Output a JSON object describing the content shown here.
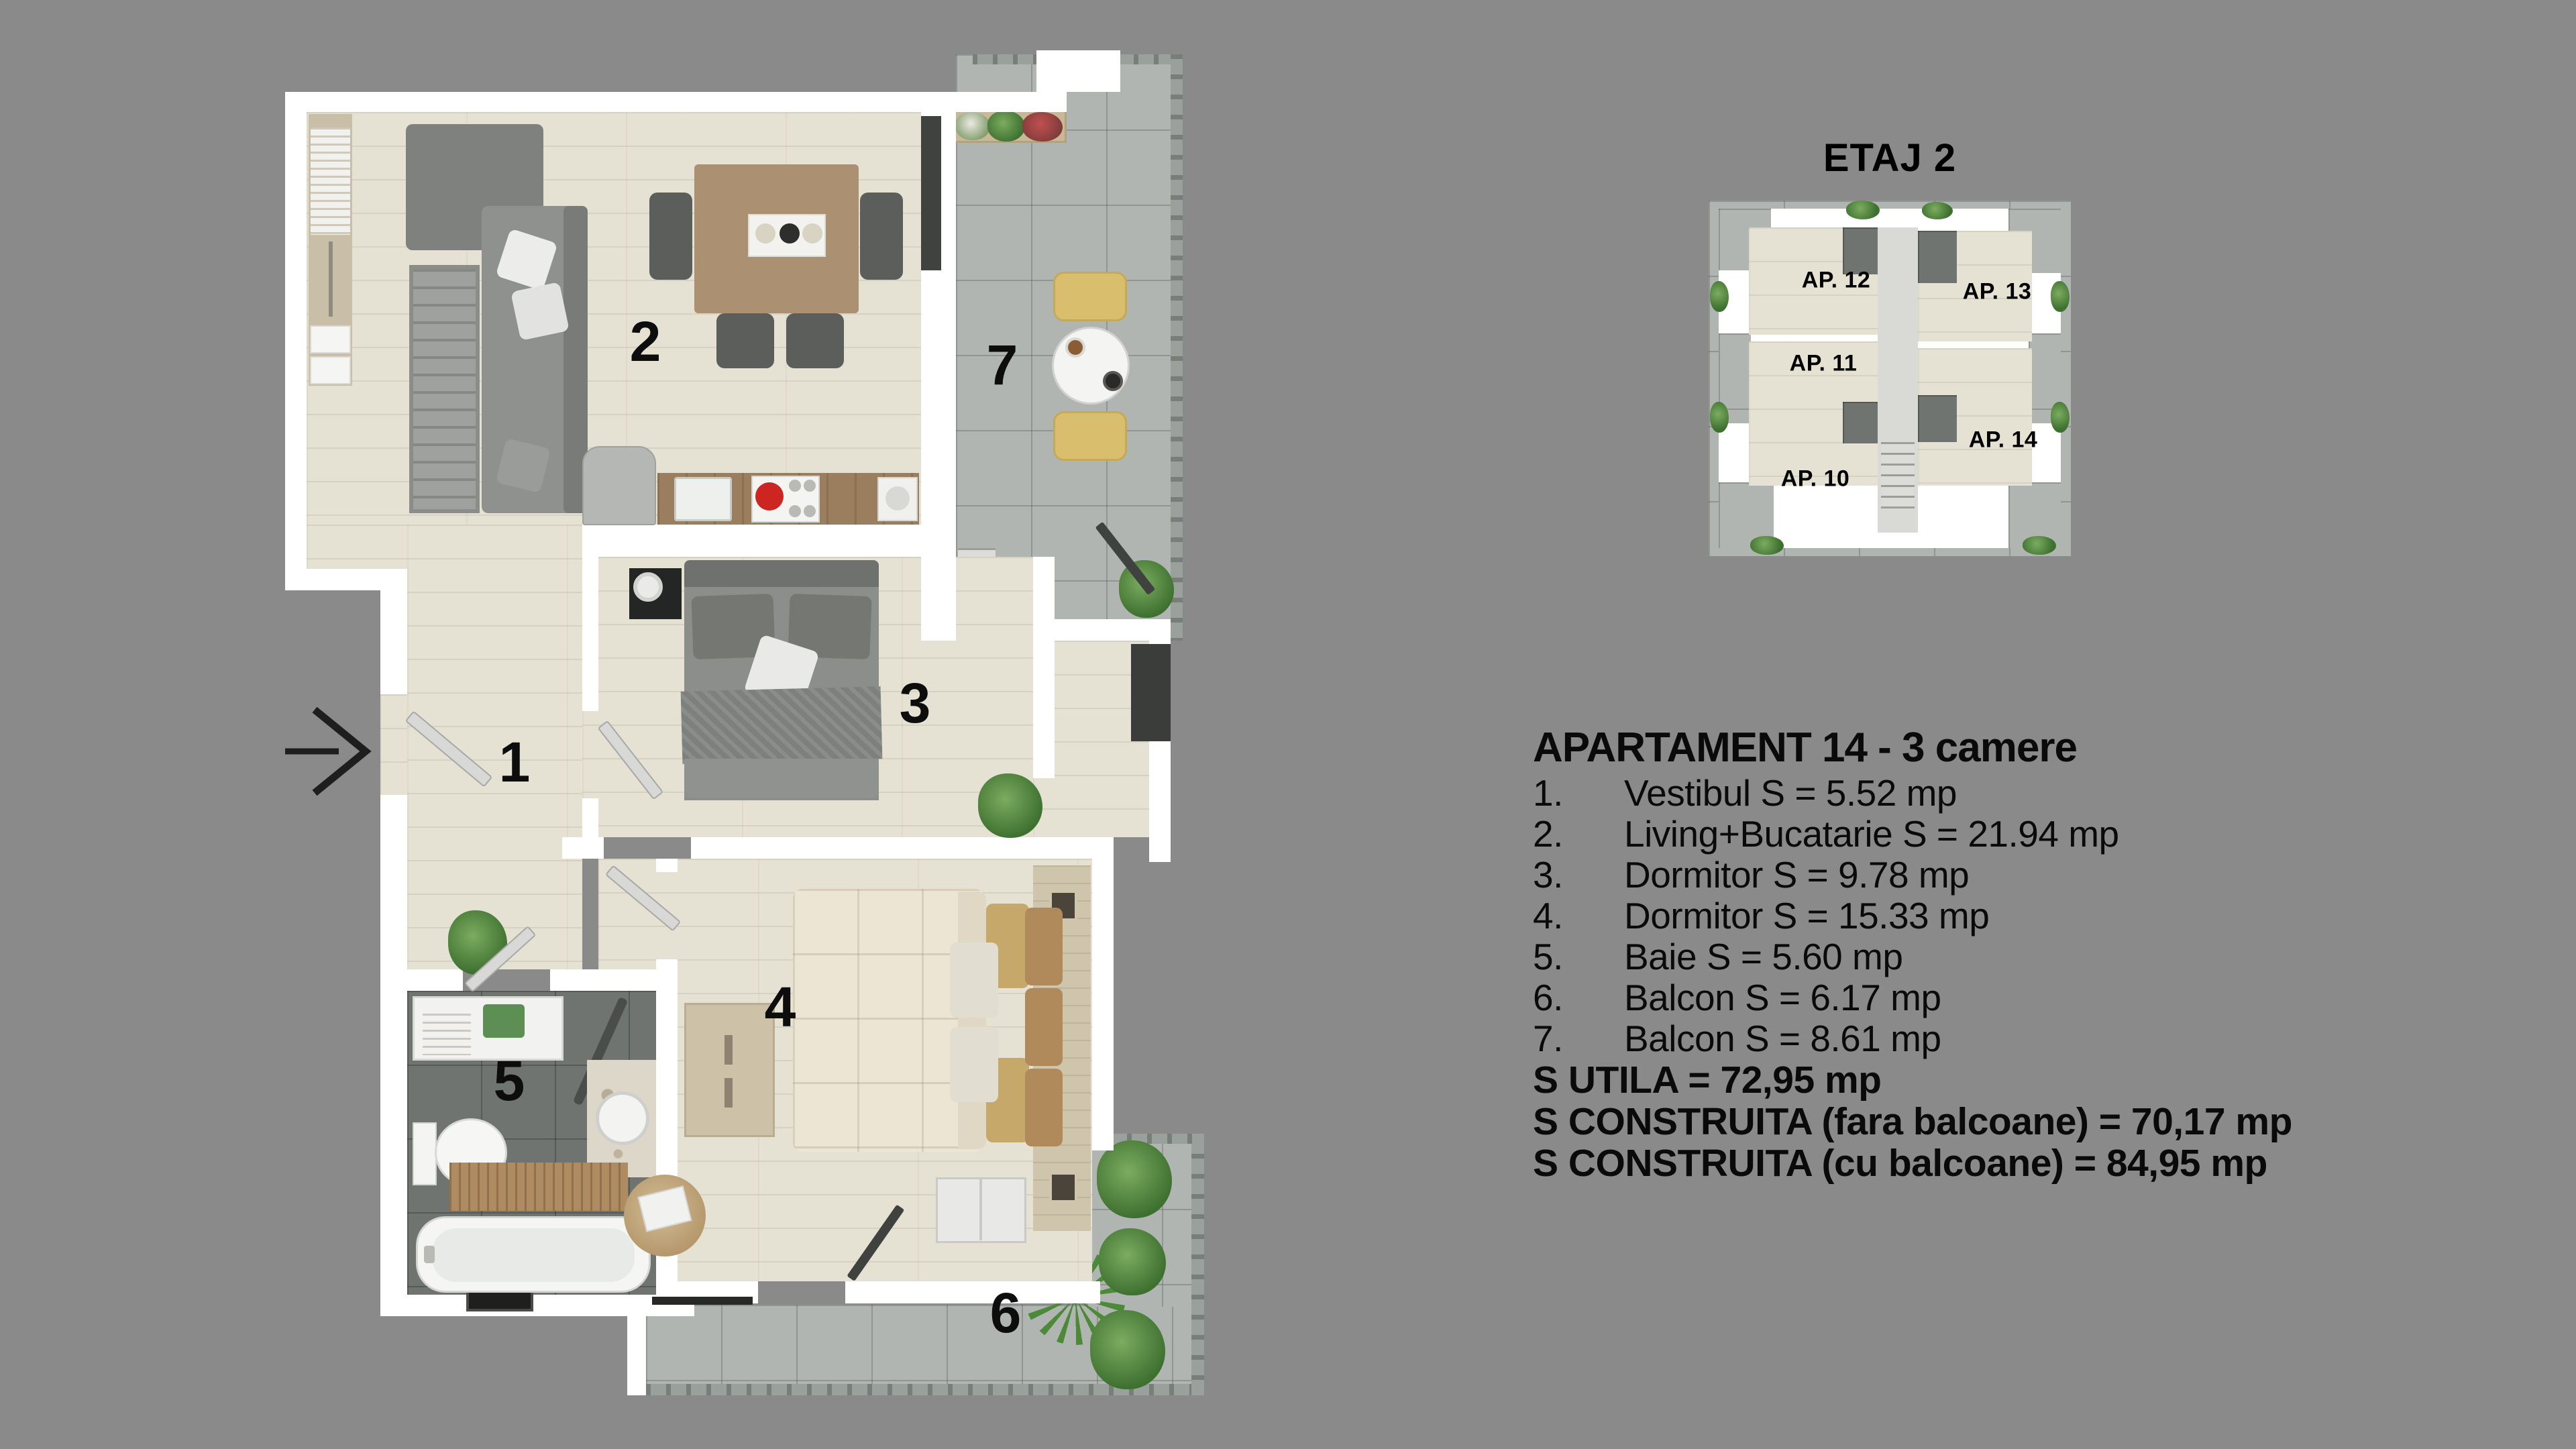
{
  "etaj_title": "ETAJ 2",
  "mini_plan": {
    "apartments": [
      {
        "label": "AP. 12"
      },
      {
        "label": "AP. 13"
      },
      {
        "label": "AP. 11"
      },
      {
        "label": "AP. 14"
      },
      {
        "label": "AP. 10"
      }
    ]
  },
  "floor_plan": {
    "rooms": [
      {
        "number": "1"
      },
      {
        "number": "2"
      },
      {
        "number": "3"
      },
      {
        "number": "4"
      },
      {
        "number": "5"
      },
      {
        "number": "6"
      },
      {
        "number": "7"
      }
    ]
  },
  "apartment_info": {
    "title": "APARTAMENT 14 - 3 camere",
    "rooms": [
      {
        "no": "1.",
        "text": "Vestibul S = 5.52 mp"
      },
      {
        "no": "2.",
        "text": "Living+Bucatarie S = 21.94 mp"
      },
      {
        "no": "3.",
        "text": "Dormitor S = 9.78 mp"
      },
      {
        "no": "4.",
        "text": "Dormitor S = 15.33 mp"
      },
      {
        "no": "5.",
        "text": "Baie S = 5.60 mp"
      },
      {
        "no": "6.",
        "text": "Balcon S = 6.17 mp"
      },
      {
        "no": "7.",
        "text": "Balcon S = 8.61 mp"
      }
    ],
    "totals": [
      {
        "text": "S UTILA = 72,95 mp"
      },
      {
        "text": "S CONSTRUITA (fara balcoane) = 70,17 mp"
      },
      {
        "text": "S CONSTRUITA (cu balcoane) = 84,95 mp"
      }
    ]
  },
  "colors": {
    "background": "#8a8a8a",
    "wall": "#ffffff",
    "wood_floor": "#e5e1d3",
    "balcony_tile": "#b1b5b2",
    "bath_tile": "#6f7471",
    "text": "#000000"
  }
}
